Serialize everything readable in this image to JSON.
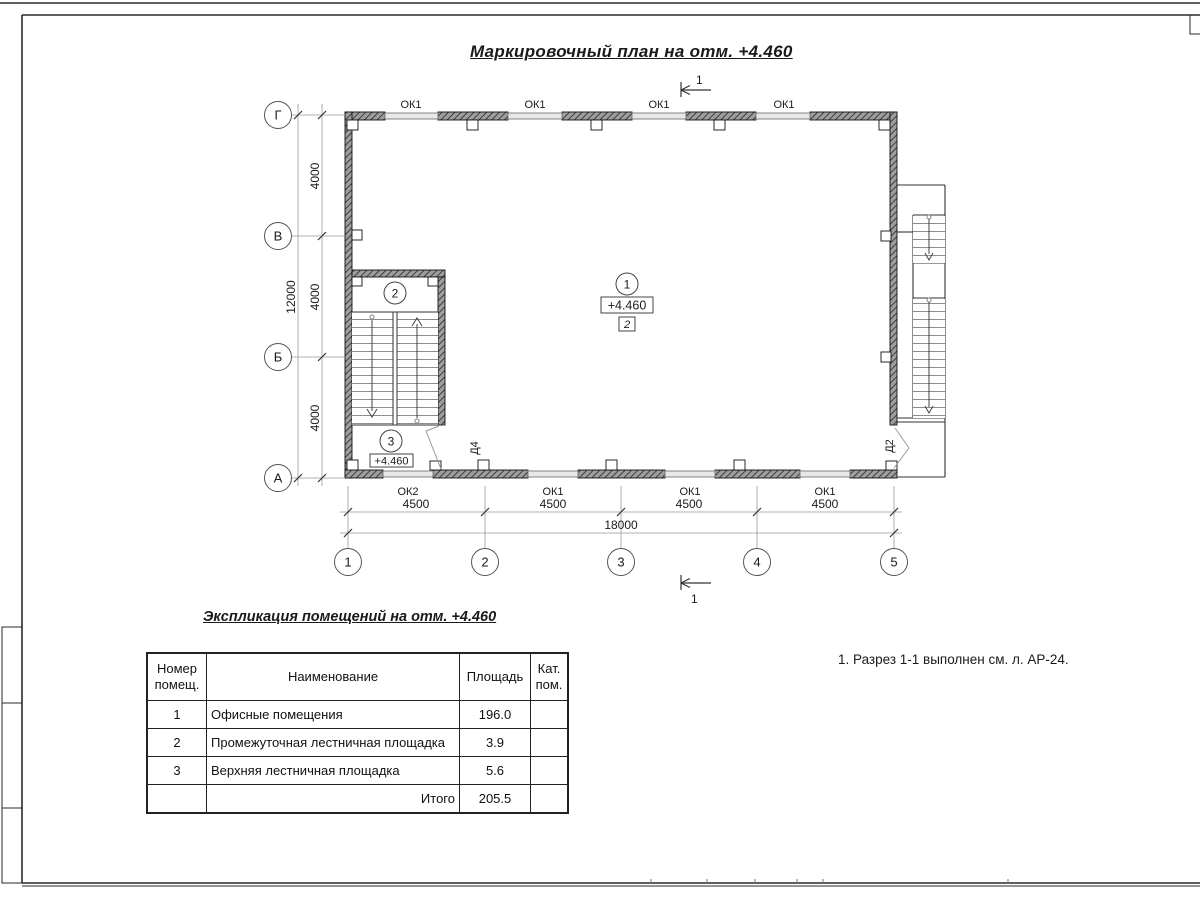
{
  "sheet": {
    "plan_title": "Маркировочный план на отм. +4.460",
    "note": "1. Разрез 1-1 выполнен см. л. АР-24."
  },
  "plan": {
    "section_mark": "1",
    "axes_row": [
      "Г",
      "В",
      "Б",
      "А"
    ],
    "axes_col": [
      "1",
      "2",
      "3",
      "4",
      "5"
    ],
    "dims_left": {
      "seg1": "4000",
      "seg2": "4000",
      "seg3": "4000",
      "total": "12000"
    },
    "dims_bottom": {
      "seg1": "4500",
      "seg2": "4500",
      "seg3": "4500",
      "seg4": "4500",
      "total": "18000"
    },
    "windows_top": [
      "ОК1",
      "ОК1",
      "ОК1",
      "ОК1"
    ],
    "windows_bottom": [
      "ОК2",
      "ОК1",
      "ОК1",
      "ОК1"
    ],
    "doors": {
      "d4": "Д4",
      "d2": "Д2"
    },
    "rooms": {
      "r1": {
        "num": "1",
        "elev": "+4.460",
        "cat": "2"
      },
      "r2": {
        "num": "2"
      },
      "r3": {
        "num": "3",
        "elev": "+4.460"
      }
    }
  },
  "table": {
    "title": "Экспликация помещений на отм. +4.460",
    "col_number": [
      "Номер",
      "помещ."
    ],
    "col_name": "Наименование",
    "col_area": "Площадь",
    "col_cat": [
      "Кат.",
      "пом."
    ],
    "rows": [
      {
        "num": "1",
        "name": "Офисные помещения",
        "area": "196.0",
        "cat": ""
      },
      {
        "num": "2",
        "name": "Промежуточная лестничная площадка",
        "area": "3.9",
        "cat": ""
      },
      {
        "num": "3",
        "name": "Верхняя лестничная площадка",
        "area": "5.6",
        "cat": ""
      }
    ],
    "total_label": "Итого",
    "total_value": "205.5"
  },
  "colors": {
    "ink": "#1a1a1a",
    "dim": "#666666",
    "wall": "#4d4d4d"
  }
}
